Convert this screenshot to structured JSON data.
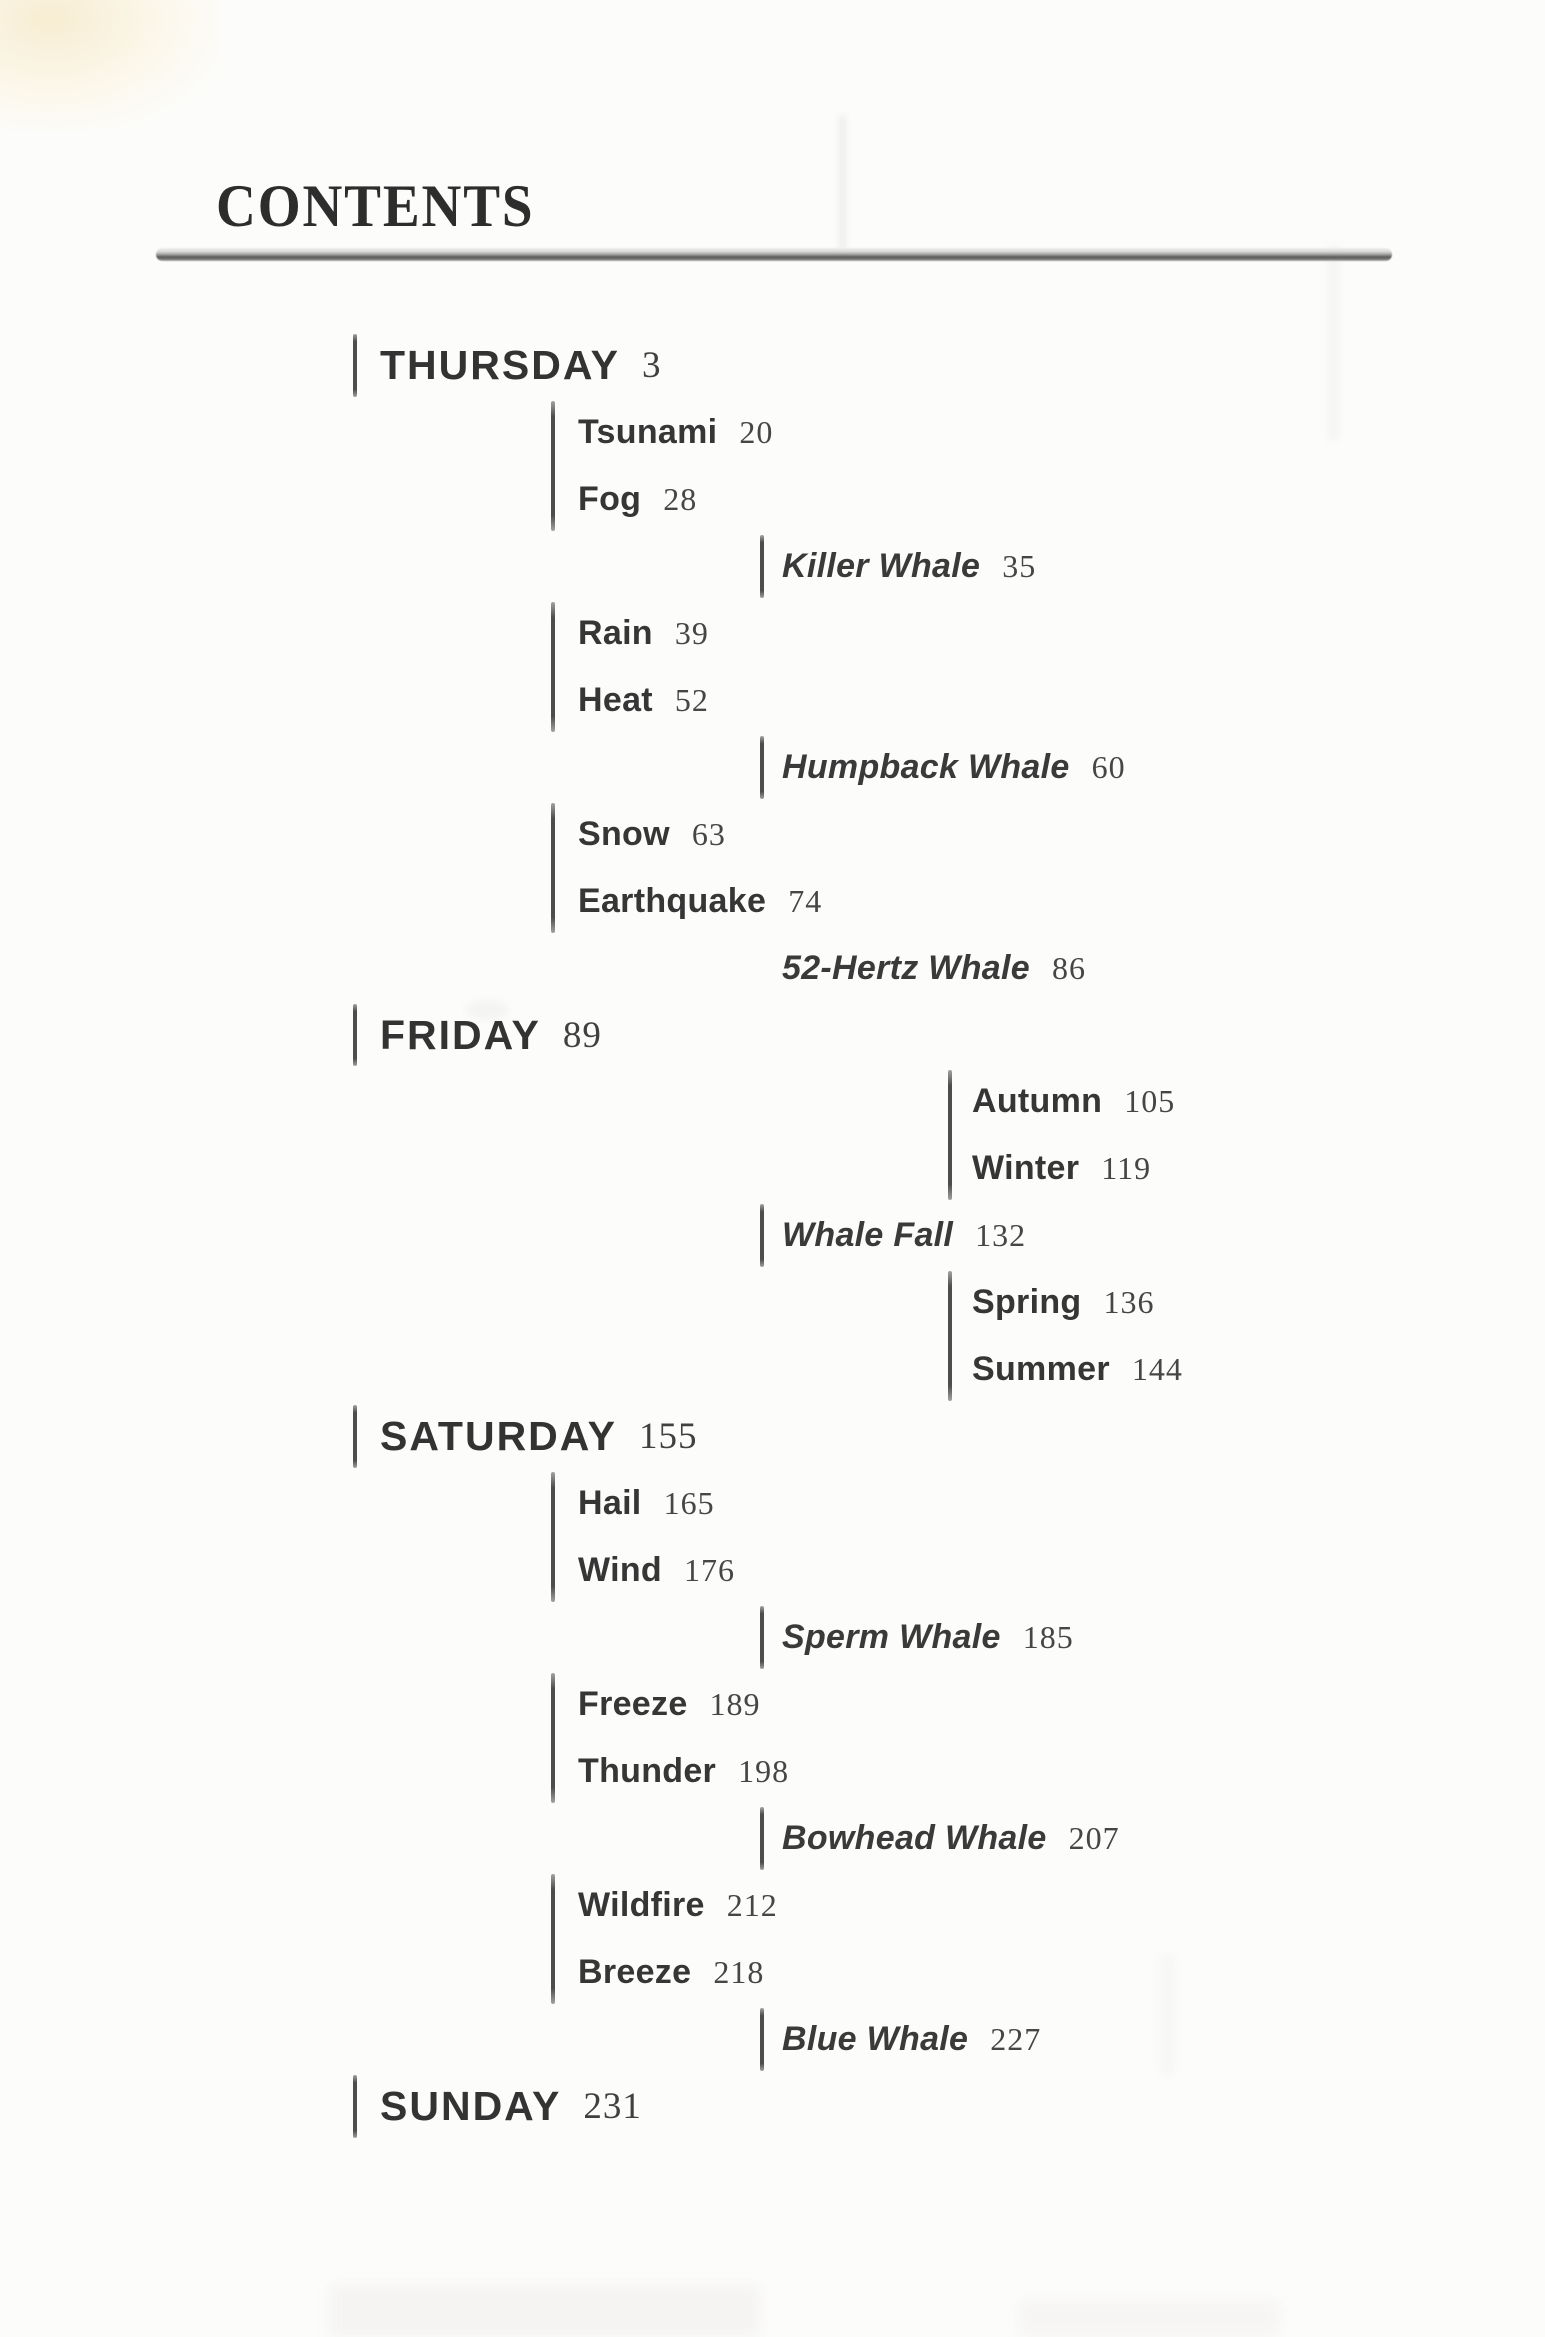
{
  "page": {
    "title": "CONTENTS",
    "background_color": "#fcfcfa",
    "ink_color": "#363636",
    "rule_color": "#5c5c5a"
  },
  "toc": {
    "entries": [
      {
        "label": "THURSDAY",
        "page": "3",
        "kind": "day",
        "bar_group": "b1"
      },
      {
        "label": "Tsunami",
        "page": "20",
        "kind": "weather",
        "bar_group": "b2"
      },
      {
        "label": "Fog",
        "page": "28",
        "kind": "weather",
        "bar_group": "b2"
      },
      {
        "label": "Killer Whale",
        "page": "35",
        "kind": "whale",
        "bar_group": "b3"
      },
      {
        "label": "Rain",
        "page": "39",
        "kind": "weather",
        "bar_group": "b4"
      },
      {
        "label": "Heat",
        "page": "52",
        "kind": "weather",
        "bar_group": "b4"
      },
      {
        "label": "Humpback Whale",
        "page": "60",
        "kind": "whale",
        "bar_group": "b5"
      },
      {
        "label": "Snow",
        "page": "63",
        "kind": "weather",
        "bar_group": "b6"
      },
      {
        "label": "Earthquake",
        "page": "74",
        "kind": "weather",
        "bar_group": "b6"
      },
      {
        "label": "52-Hertz Whale",
        "page": "86",
        "kind": "whale",
        "bar_group": null
      },
      {
        "label": "FRIDAY",
        "page": "89",
        "kind": "day",
        "bar_group": "b7"
      },
      {
        "label": "Autumn",
        "page": "105",
        "kind": "season",
        "bar_group": "b8"
      },
      {
        "label": "Winter",
        "page": "119",
        "kind": "season",
        "bar_group": "b8"
      },
      {
        "label": "Whale Fall",
        "page": "132",
        "kind": "whale",
        "bar_group": "b9"
      },
      {
        "label": "Spring",
        "page": "136",
        "kind": "season",
        "bar_group": "b10"
      },
      {
        "label": "Summer",
        "page": "144",
        "kind": "season",
        "bar_group": "b10"
      },
      {
        "label": "SATURDAY",
        "page": "155",
        "kind": "day",
        "bar_group": "b11"
      },
      {
        "label": "Hail",
        "page": "165",
        "kind": "weather",
        "bar_group": "b12"
      },
      {
        "label": "Wind",
        "page": "176",
        "kind": "weather",
        "bar_group": "b12"
      },
      {
        "label": "Sperm Whale",
        "page": "185",
        "kind": "whale",
        "bar_group": "b13"
      },
      {
        "label": "Freeze",
        "page": "189",
        "kind": "weather",
        "bar_group": "b14"
      },
      {
        "label": "Thunder",
        "page": "198",
        "kind": "weather",
        "bar_group": "b14"
      },
      {
        "label": "Bowhead Whale",
        "page": "207",
        "kind": "whale",
        "bar_group": "b15"
      },
      {
        "label": "Wildfire",
        "page": "212",
        "kind": "weather",
        "bar_group": "b16"
      },
      {
        "label": "Breeze",
        "page": "218",
        "kind": "weather",
        "bar_group": "b16"
      },
      {
        "label": "Blue Whale",
        "page": "227",
        "kind": "whale",
        "bar_group": "b17"
      },
      {
        "label": "SUNDAY",
        "page": "231",
        "kind": "day",
        "bar_group": "b18"
      }
    ]
  }
}
